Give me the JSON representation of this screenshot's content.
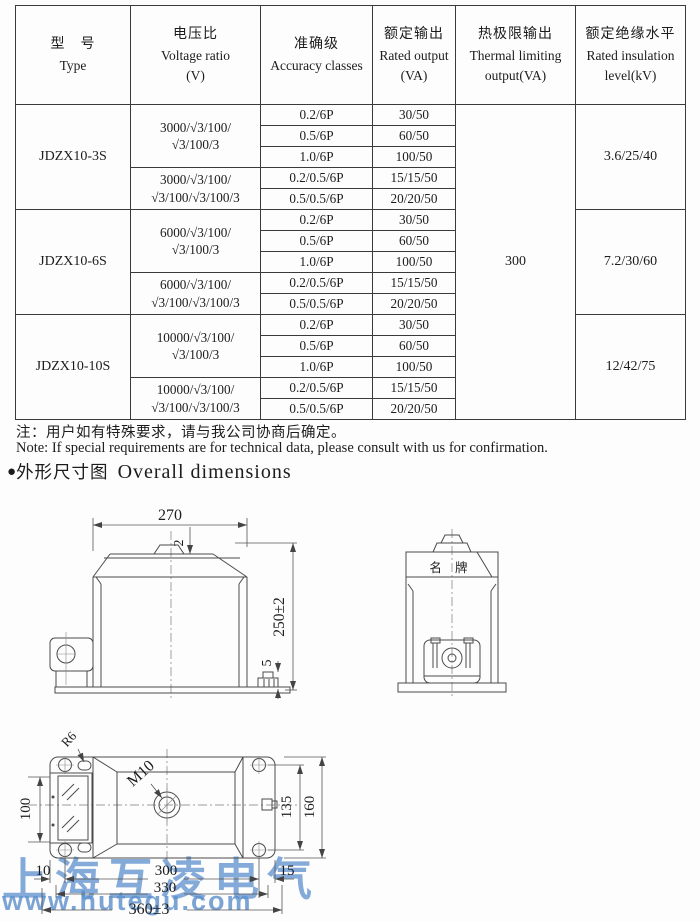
{
  "table": {
    "headers": {
      "type_cn": "型　号",
      "type_en": "Type",
      "ratio_cn": "电压比",
      "ratio_en": "Voltage ratio",
      "ratio_unit": "(V)",
      "accuracy_cn": "准确级",
      "accuracy_en": "Accuracy classes",
      "output_cn": "额定输出",
      "output_en": "Rated output",
      "output_unit": "(VA)",
      "thermal_cn": "热极限输出",
      "thermal_en": "Thermal limiting",
      "thermal_unit": "output(VA)",
      "insulation_cn": "额定绝缘水平",
      "insulation_en": "Rated insulation",
      "insulation_unit": "level(kV)"
    },
    "thermal_value": "300",
    "groups": [
      {
        "type": "JDZX10-3S",
        "insulation": "3.6/25/40",
        "ratios": [
          {
            "line1": "3000/√3/100/",
            "line2": "√3/100/3",
            "rows": [
              {
                "acc": "0.2/6P",
                "out": "30/50"
              },
              {
                "acc": "0.5/6P",
                "out": "60/50"
              },
              {
                "acc": "1.0/6P",
                "out": "100/50"
              }
            ]
          },
          {
            "line1": "3000/√3/100/",
            "line2": "√3/100/√3/100/3",
            "rows": [
              {
                "acc": "0.2/0.5/6P",
                "out": "15/15/50"
              },
              {
                "acc": "0.5/0.5/6P",
                "out": "20/20/50"
              }
            ]
          }
        ]
      },
      {
        "type": "JDZX10-6S",
        "insulation": "7.2/30/60",
        "ratios": [
          {
            "line1": "6000/√3/100/",
            "line2": "√3/100/3",
            "rows": [
              {
                "acc": "0.2/6P",
                "out": "30/50"
              },
              {
                "acc": "0.5/6P",
                "out": "60/50"
              },
              {
                "acc": "1.0/6P",
                "out": "100/50"
              }
            ]
          },
          {
            "line1": "6000/√3/100/",
            "line2": "√3/100/√3/100/3",
            "rows": [
              {
                "acc": "0.2/0.5/6P",
                "out": "15/15/50"
              },
              {
                "acc": "0.5/0.5/6P",
                "out": "20/20/50"
              }
            ]
          }
        ]
      },
      {
        "type": "JDZX10-10S",
        "insulation": "12/42/75",
        "ratios": [
          {
            "line1": "10000/√3/100/",
            "line2": "√3/100/3",
            "rows": [
              {
                "acc": "0.2/6P",
                "out": "30/50"
              },
              {
                "acc": "0.5/6P",
                "out": "60/50"
              },
              {
                "acc": "1.0/6P",
                "out": "100/50"
              }
            ]
          },
          {
            "line1": "10000/√3/100/",
            "line2": "√3/100/√3/100/3",
            "rows": [
              {
                "acc": "0.2/0.5/6P",
                "out": "15/15/50"
              },
              {
                "acc": "0.5/0.5/6P",
                "out": "20/20/50"
              }
            ]
          }
        ]
      }
    ]
  },
  "notes": {
    "cn": "注：用户如有特殊要求，请与我公司协商后确定。",
    "en": "Note: If special requirements are for technical data, please consult with us for confirmation."
  },
  "section": {
    "bullet": "●",
    "title_cn": "外形尺寸图",
    "title_en": "Overall dimensions"
  },
  "drawings": {
    "front_view": {
      "dim_width": "270",
      "dim_bump": "2",
      "dim_height": "250±2",
      "dim_base": "5"
    },
    "side_view": {
      "nameplate": "名 牌"
    },
    "bottom_view": {
      "label_fillet": "R6",
      "label_thread": "M10",
      "dim_left": "100",
      "dim_holes_v": "135",
      "dim_right_v": "160",
      "dim_edge_left": "10",
      "dim_holes_h": "300",
      "dim_edge_right": "15",
      "dim_mid": "330",
      "dim_total": "360±3"
    }
  },
  "watermark": {
    "company": "上海互凌电气",
    "url": "www.hutegu.com",
    "color": "#5b8fcc"
  }
}
